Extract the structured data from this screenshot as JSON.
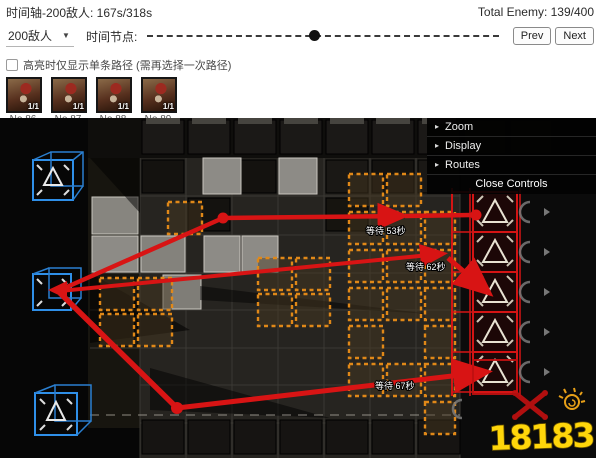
{
  "toolbar": {
    "timeline_label": "时间轴-200敌人: 167s/318s",
    "total_enemy_label": "Total Enemy: 139/400",
    "enemy_select_value": "200敌人",
    "time_node_label": "时间节点:",
    "prev_label": "Prev",
    "next_label": "Next",
    "slider_percent": 46
  },
  "highlight": {
    "label": "高亮时仅显示单条路径 (需再选择一次路径)",
    "checked": false
  },
  "enemies": [
    {
      "count": "1/1",
      "number": "No.86"
    },
    {
      "count": "1/1",
      "number": "No.87"
    },
    {
      "count": "1/1",
      "number": "No.88"
    },
    {
      "count": "1/1",
      "number": "No.89"
    }
  ],
  "controls_panel": {
    "folders": [
      "Zoom",
      "Display",
      "Routes"
    ],
    "close_label": "Close Controls"
  },
  "map": {
    "wait_labels": [
      "等待 53秒",
      "等待 62秒",
      "等待 67秒"
    ],
    "watermark": "18183",
    "colors": {
      "route": "#d81414",
      "spawn_box": "#2f8fe8",
      "gate_box": "#d41414",
      "tile_highlight": "#e08818",
      "watermark_yellow": "#ffd60a"
    }
  }
}
